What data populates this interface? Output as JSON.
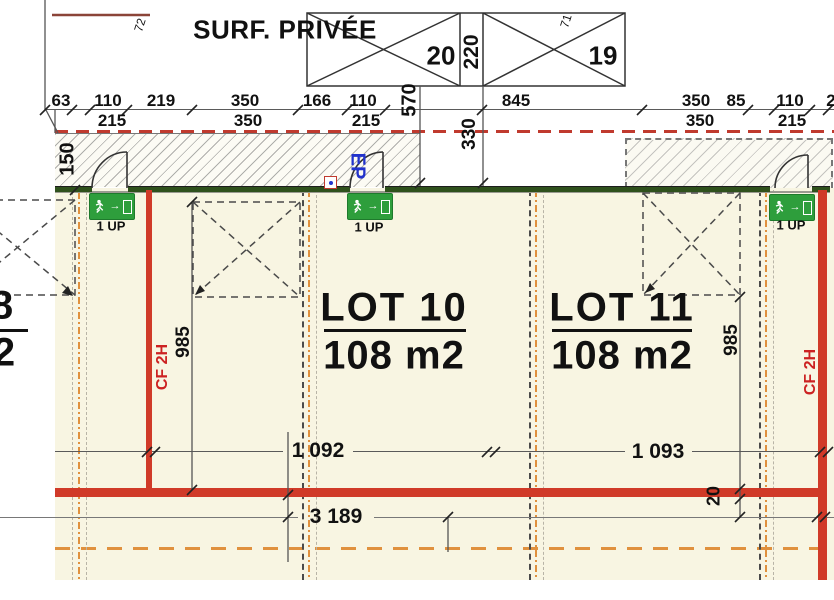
{
  "header": {
    "title": "SURF. PRIVÉE",
    "ref_left": "72",
    "ref_right": "71",
    "box_left": "20",
    "box_divider": "220",
    "box_right": "19"
  },
  "top_dims": {
    "row1": [
      "63",
      "110",
      "219",
      "350",
      "166",
      "110",
      "845",
      "350",
      "85",
      "110",
      "2"
    ],
    "row2": [
      "215",
      "350",
      "215",
      "350",
      "215"
    ]
  },
  "vertical_dims": {
    "v150": "150",
    "v570": "570",
    "v330": "330",
    "v985_left": "985",
    "v985_right": "985",
    "v20": "20"
  },
  "bottom_dims": {
    "b1092": "1 092",
    "b1093": "1 093",
    "b3189": "3 189"
  },
  "lots": {
    "lot10": {
      "name": "LOT 10",
      "area": "108 m2"
    },
    "lot11": {
      "name": "LOT 11",
      "area": "108 m2"
    },
    "partial_left": {
      "line1": "8",
      "line2": "2"
    }
  },
  "fire_rating": {
    "left": "CF 2H",
    "right": "CF 2H"
  },
  "signs": {
    "exit_label": "1 UP"
  },
  "utilities": {
    "ep": "EP"
  },
  "colors": {
    "floor": "#F8F5E2",
    "wall_red": "#D03A28",
    "wall_green": "#2F511C",
    "exit_green": "#2E9E3C",
    "axis_orange": "#E0913E",
    "boundary_red_dashed": "#C03A2E",
    "fire_label_red": "#CC2222",
    "ep_blue": "#2233CC"
  }
}
